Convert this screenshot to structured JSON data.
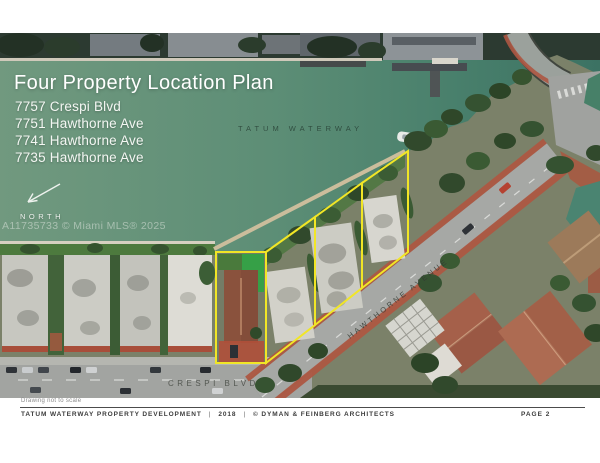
{
  "colors": {
    "parcel_outline": "#f1e626",
    "water": "#5d8e76",
    "brick_sidewalk": "#ad5742",
    "title_text": "#ffffff",
    "footer_text": "#3c3c3c"
  },
  "slide": {
    "title": "Four Property Location Plan",
    "addresses": [
      "7757 Crespi Blvd",
      "7751 Hawthorne Ave",
      "7741 Hawthorne Ave",
      "7735 Hawthorne Ave"
    ],
    "north_label": "NORTH",
    "watermark": "A11735733 © Miami MLS® 2025",
    "scale_note": "Drawing not to scale"
  },
  "map": {
    "water_label": "TATUM WATERWAY",
    "hawthorne_label": "HAWTHORNE AVENUE",
    "crespi_label": "CRESPI BLVD",
    "parcel_count": "4"
  },
  "footer": {
    "project": "TATUM WATERWAY PROPERTY DEVELOPMENT",
    "separator": "|",
    "year": "2018",
    "credit": "© DYMAN & FEINBERG ARCHITECTS",
    "page": "PAGE 2"
  }
}
